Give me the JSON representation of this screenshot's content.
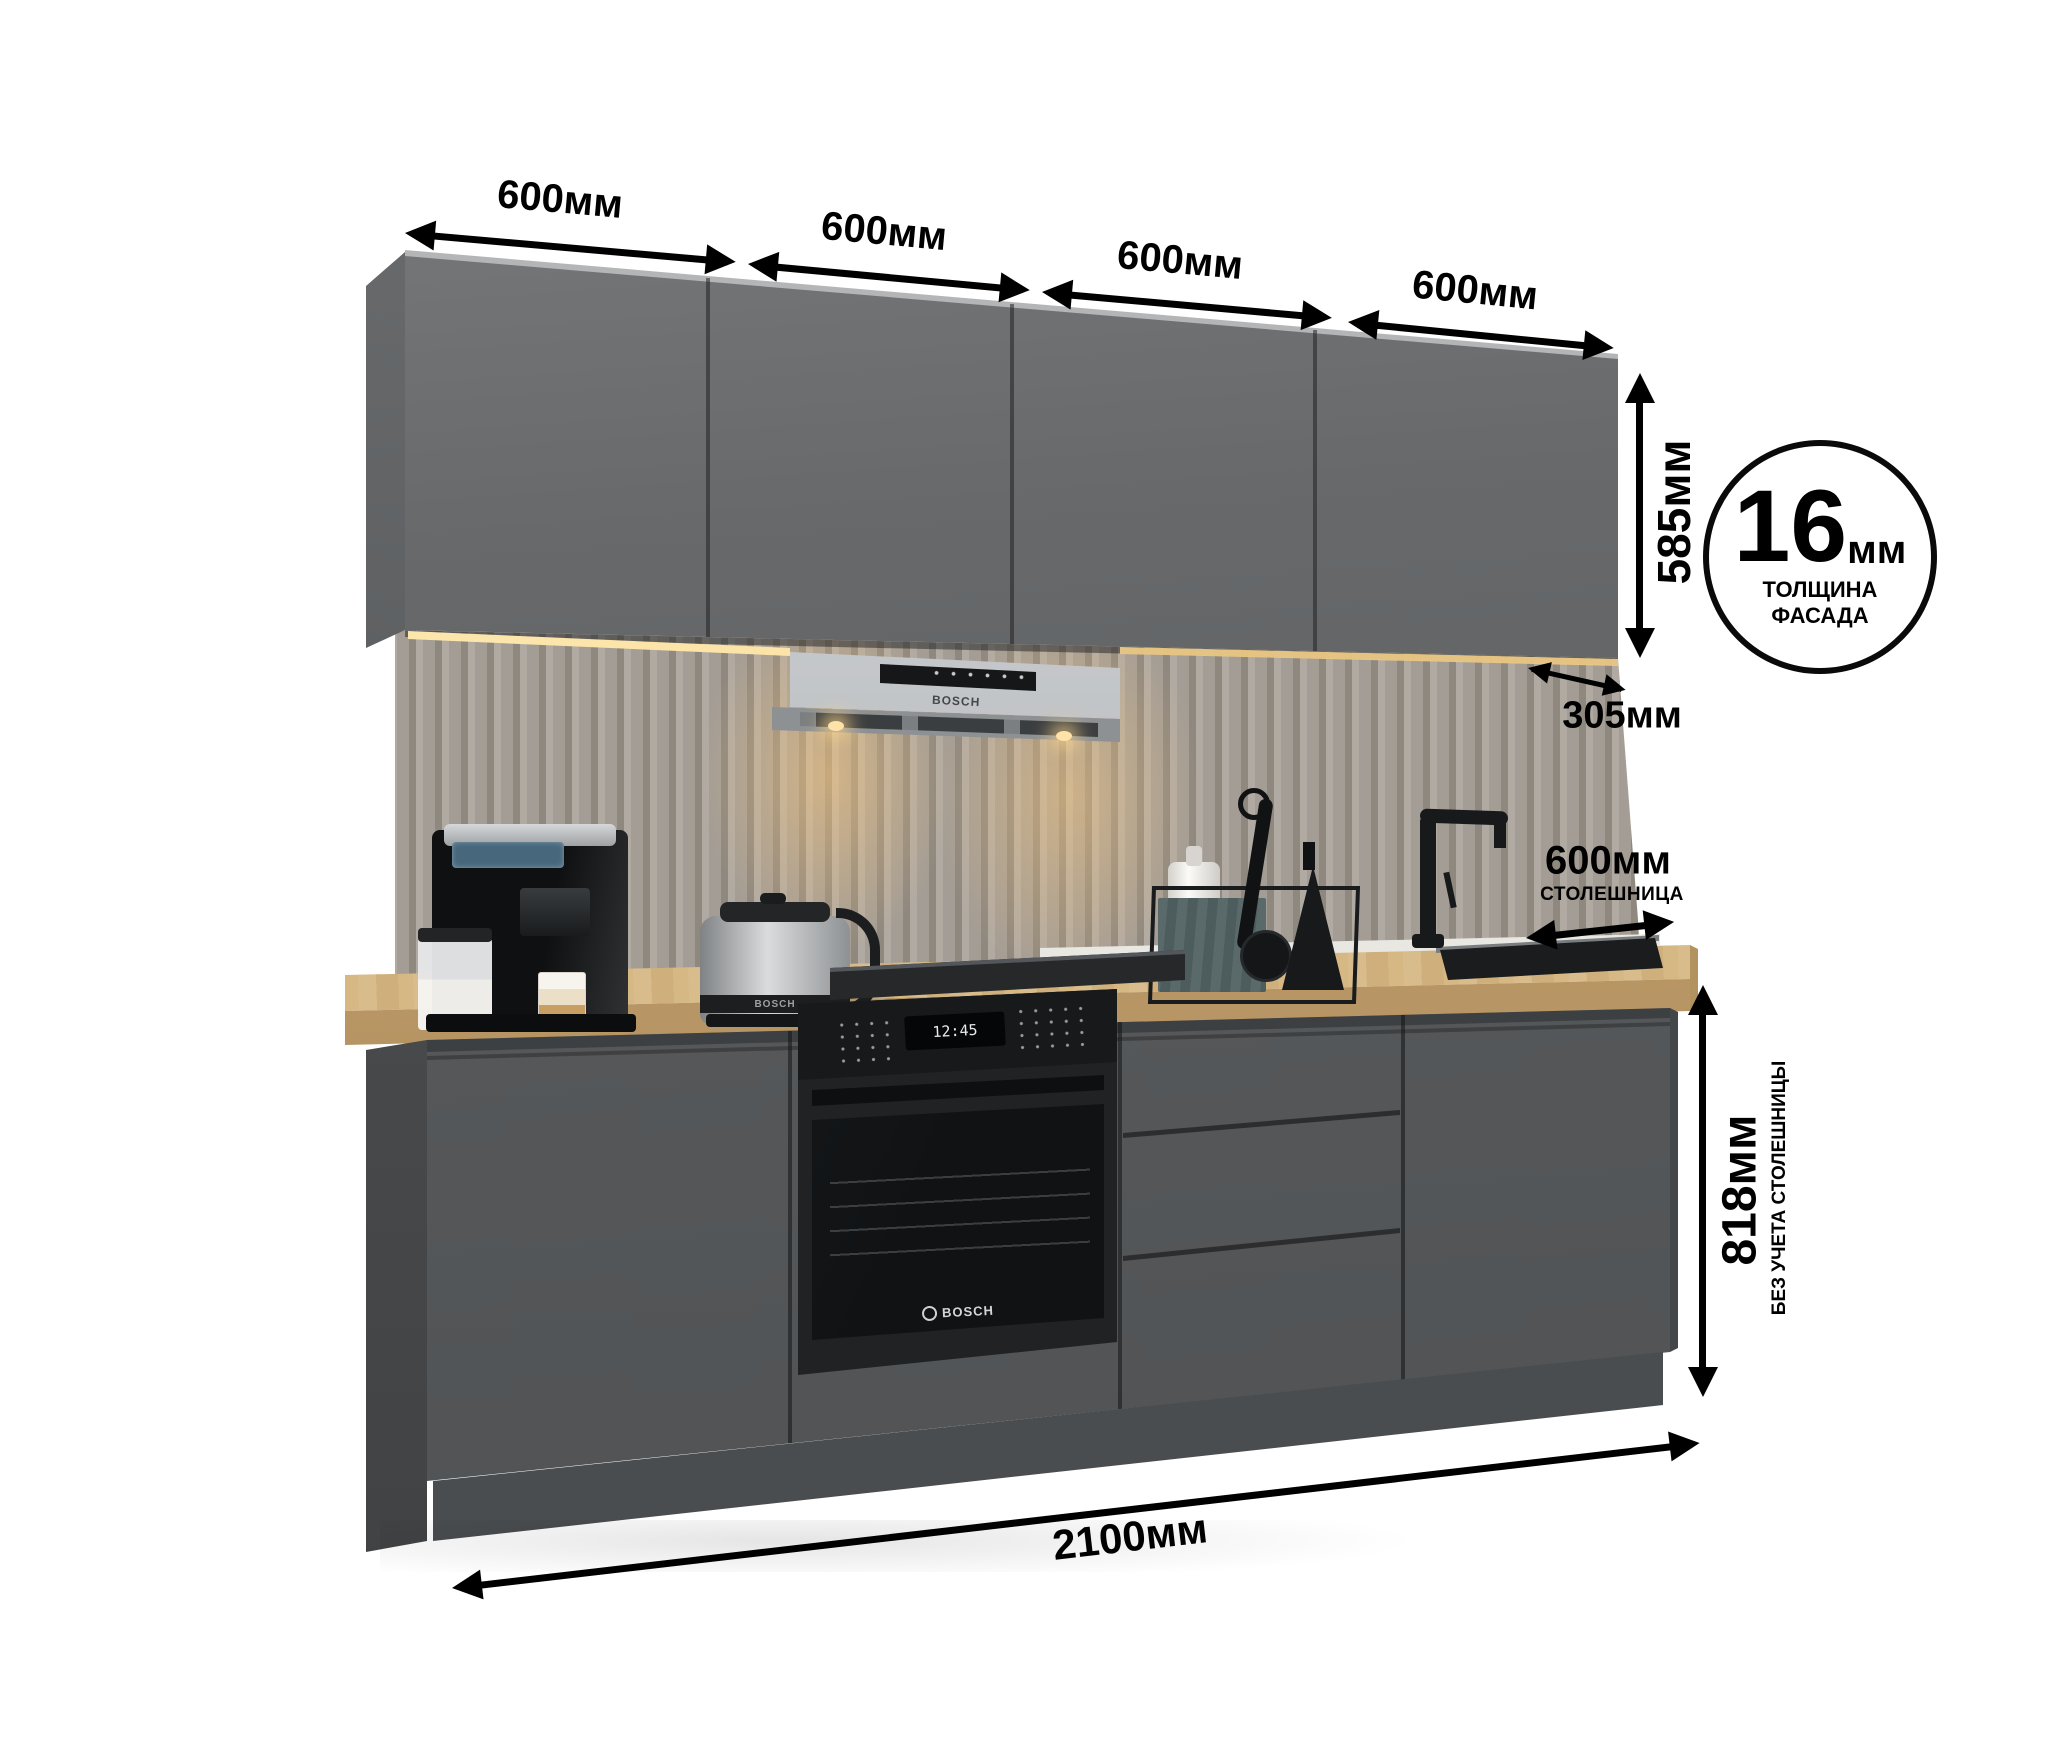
{
  "diagram": {
    "subject": "kitchen-set-dimension-diagram",
    "dimensions": {
      "top_widths": [
        {
          "label": "600мм"
        },
        {
          "label": "600мм"
        },
        {
          "label": "600мм"
        },
        {
          "label": "600мм"
        }
      ],
      "wall_cabinet_height": {
        "label": "585мм"
      },
      "wall_cabinet_depth": {
        "label": "305мм"
      },
      "countertop_depth": {
        "label": "600мм",
        "caption": "СТОЛЕШНИЦА"
      },
      "base_height": {
        "label": "818мм",
        "caption": "БЕЗ УЧЕТА СТОЛЕШНИЦЫ"
      },
      "total_width": {
        "label": "2100мм"
      },
      "facade_thickness": {
        "value": "16",
        "unit": "мм",
        "caption_line1": "ТОЛЩИНА",
        "caption_line2": "ФАСАДА"
      }
    },
    "appliances": {
      "hood_brand": "BOSCH",
      "oven_clock": "12:45",
      "oven_brand": "BOSCH",
      "kettle_brand": "BOSCH"
    },
    "colors": {
      "arrow": "#000000",
      "cabinet-front": "#5d6062",
      "cabinet-side": "#4b4e50",
      "counter-top": "#d3b584",
      "counter-front": "#bb9866",
      "backsplash": "#a49d95",
      "led": "#f6d896",
      "hood": "#c6c9cb",
      "appliance-black": "#17191b",
      "plinth": "#4a4d4f"
    }
  }
}
